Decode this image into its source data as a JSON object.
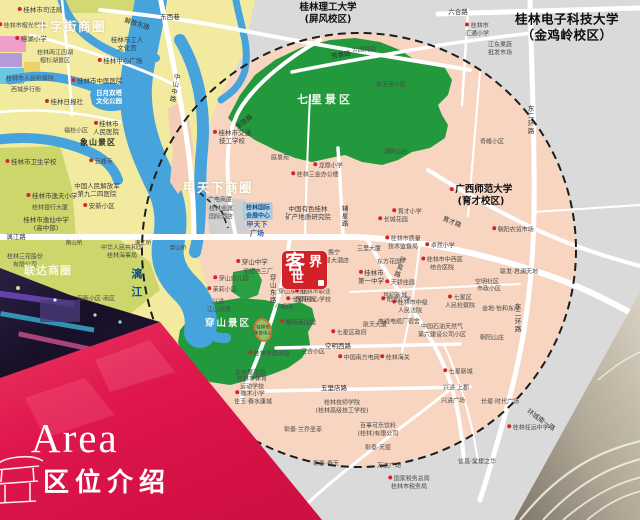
{
  "banner": {
    "title_en": "Area",
    "title_zh": "区位介绍"
  },
  "logo": {
    "c1": "客",
    "c2": "界",
    "c3": "世"
  },
  "colors": {
    "zone_pink": "#f7d5c0",
    "outside_gray": "#dadada",
    "downtown_yellow": "#f2eb9f",
    "yellow_green": "#cdd66b",
    "park_green": "#23993e",
    "river_blue": "#47a3dc",
    "road_white": "#ffffff",
    "logo_red": "#d32227",
    "banner_red": "#de164c",
    "dashed_boundary": "#1c1c1c"
  },
  "map": {
    "labels": [
      {
        "t": "桂林市司法局",
        "x": 40,
        "y": 10,
        "c": "poi",
        "m": 1
      },
      {
        "t": "桂林市榕光学校",
        "x": 22,
        "y": 26,
        "c": "poi-sm",
        "m": 1
      },
      {
        "t": "十字街商圈",
        "x": 71,
        "y": 27,
        "c": "biz"
      },
      {
        "t": "解放东路",
        "x": 137,
        "y": 24,
        "c": "road",
        "r": 18
      },
      {
        "t": "东西巷",
        "x": 170,
        "y": 17,
        "c": "road"
      },
      {
        "t": "榕湖小学",
        "x": 31,
        "y": 39,
        "c": "poi",
        "m": 1
      },
      {
        "t": "桂林市工人\n文化宫",
        "x": 127,
        "y": 44,
        "c": "poi"
      },
      {
        "t": "桂林中心广场",
        "x": 120,
        "y": 61,
        "c": "poi",
        "m": 1
      },
      {
        "t": "桂林两江四湖\n榕杉湖景区",
        "x": 55,
        "y": 57,
        "c": "poi-sm"
      },
      {
        "t": "桂林市人民检察院",
        "x": 30,
        "y": 79,
        "c": "poi-sm"
      },
      {
        "t": "桂林市中医医院",
        "x": 97,
        "y": 81,
        "c": "poi",
        "m": 1
      },
      {
        "t": "西城步行街",
        "x": 26,
        "y": 90,
        "c": "poi-sm"
      },
      {
        "t": "桂林日报社",
        "x": 64,
        "y": 102,
        "c": "poi",
        "m": 1
      },
      {
        "t": "日月双塔\n文化公园",
        "x": 109,
        "y": 97,
        "c": "wpark"
      },
      {
        "t": "中山中路",
        "x": 174,
        "y": 88,
        "c": "roadv",
        "r": 10
      },
      {
        "t": "桂林市\n人民医院",
        "x": 106,
        "y": 128,
        "c": "poi",
        "m": 1
      },
      {
        "t": "象山景区",
        "x": 98,
        "y": 143,
        "c": "scenic"
      },
      {
        "t": "福桂小区",
        "x": 76,
        "y": 131,
        "c": "poi-sm"
      },
      {
        "t": "桂林市卫生学校",
        "x": 31,
        "y": 162,
        "c": "poi",
        "m": 1
      },
      {
        "t": "云峰寺",
        "x": 101,
        "y": 162,
        "c": "poi-sm",
        "m": 1
      },
      {
        "t": "中国人民解放军\n第九二四医院",
        "x": 97,
        "y": 190,
        "c": "poi"
      },
      {
        "t": "桂林市逸夫小学",
        "x": 52,
        "y": 196,
        "c": "poi",
        "m": 1
      },
      {
        "t": "桂林银行大厦",
        "x": 50,
        "y": 208,
        "c": "poi-sm"
      },
      {
        "t": "桂林市逸仙中学\n(高中部)",
        "x": 46,
        "y": 224,
        "c": "poi"
      },
      {
        "t": "安新小区",
        "x": 99,
        "y": 206,
        "c": "poi",
        "m": 1
      },
      {
        "t": "漓江路",
        "x": 16,
        "y": 237,
        "c": "road"
      },
      {
        "t": "南山桥",
        "x": 74,
        "y": 244,
        "c": "bridge"
      },
      {
        "t": "漓江桥",
        "x": 143,
        "y": 244,
        "c": "bridge"
      },
      {
        "t": "穿山桥",
        "x": 178,
        "y": 249,
        "c": "bridge"
      },
      {
        "t": "中华人民共和国\n桂林海事局",
        "x": 122,
        "y": 252,
        "c": "poi-sm"
      },
      {
        "t": "桂林三花股份\n有限公司",
        "x": 25,
        "y": 261,
        "c": "poi-sm"
      },
      {
        "t": "联达商圈",
        "x": 48,
        "y": 271,
        "c": "biz2"
      },
      {
        "t": "漓江",
        "x": 136,
        "y": 286,
        "c": "water"
      },
      {
        "t": "安新小区·南区",
        "x": 96,
        "y": 299,
        "c": "poi-sm"
      },
      {
        "t": "茉莉小区",
        "x": 222,
        "y": 290,
        "c": "poi-sm",
        "m": 1
      },
      {
        "t": "兴进·\n江山领秀",
        "x": 219,
        "y": 306,
        "c": "poi-sm"
      },
      {
        "t": "穿山景区",
        "x": 228,
        "y": 324,
        "c": "park"
      },
      {
        "t": "桂林市\n体育中心",
        "x": 263,
        "y": 331,
        "c": "stadium"
      },
      {
        "t": "穿山中学",
        "x": 252,
        "y": 262,
        "c": "poi",
        "m": 1
      },
      {
        "t": "无线电三厂",
        "x": 258,
        "y": 272,
        "c": "poi-sm"
      },
      {
        "t": "穿山幼儿园",
        "x": 231,
        "y": 279,
        "c": "poi-sm",
        "m": 1
      },
      {
        "t": "桂林市职业\n教育中心学校",
        "x": 313,
        "y": 296,
        "c": "poi-sm",
        "m": 1
      },
      {
        "t": "穿山东路",
        "x": 272,
        "y": 289,
        "c": "roadv"
      },
      {
        "t": "穿山东社区",
        "x": 293,
        "y": 292,
        "c": "poi-sm"
      },
      {
        "t": "七星花园",
        "x": 301,
        "y": 300,
        "c": "poi-sm",
        "m": 1
      },
      {
        "t": "小甫园",
        "x": 284,
        "y": 307,
        "c": "poi-sm"
      },
      {
        "t": "樱特莱庄园",
        "x": 298,
        "y": 323,
        "c": "poi-sm",
        "m": 1
      },
      {
        "t": "达京樱花园",
        "x": 250,
        "y": 373,
        "c": "poi-sm"
      },
      {
        "t": "桂林市体育\n运动学校",
        "x": 252,
        "y": 383,
        "c": "poi-sm"
      },
      {
        "t": "橡木小学",
        "x": 250,
        "y": 394,
        "c": "poi-sm",
        "m": 1
      },
      {
        "t": "佳玉·春水康城",
        "x": 253,
        "y": 402,
        "c": "poi-sm"
      },
      {
        "t": "龙隐路",
        "x": 244,
        "y": 122,
        "c": "road",
        "r": -38
      },
      {
        "t": "桂林市交通\n技工学校",
        "x": 232,
        "y": 137,
        "c": "poi",
        "m": 1
      },
      {
        "t": "甲天下商圈",
        "x": 218,
        "y": 188,
        "c": "biz"
      },
      {
        "t": "广电商厦",
        "x": 220,
        "y": 200,
        "c": "poi-sm"
      },
      {
        "t": "桂林金属\n国际酒店",
        "x": 221,
        "y": 213,
        "c": "poi-sm"
      },
      {
        "t": "桂林国际\n会展中心",
        "x": 258,
        "y": 212,
        "c": "expo"
      },
      {
        "t": "甲天下\n广场",
        "x": 257,
        "y": 229,
        "c": "blue-bold"
      },
      {
        "t": "中国有色桂林\n矿产地质研究院",
        "x": 308,
        "y": 213,
        "c": "poi"
      },
      {
        "t": "桂林三金办公楼",
        "x": 315,
        "y": 175,
        "c": "poi-sm",
        "m": 1
      },
      {
        "t": "龙隐小学",
        "x": 328,
        "y": 166,
        "c": "poi-sm",
        "m": 1
      },
      {
        "t": "庭景苑",
        "x": 280,
        "y": 158,
        "c": "poi-sm"
      },
      {
        "t": "辅星路",
        "x": 344,
        "y": 216,
        "c": "roadv"
      },
      {
        "t": "七星景区",
        "x": 325,
        "y": 100,
        "c": "park-lg"
      },
      {
        "t": "桂林理工大学\n(屏风校区)",
        "x": 328,
        "y": 14,
        "c": "u1"
      },
      {
        "t": "芳香路",
        "x": 341,
        "y": 55,
        "c": "road",
        "r": -10
      },
      {
        "t": "公园林韵",
        "x": 364,
        "y": 50,
        "c": "poi-sm"
      },
      {
        "t": "航天苑小区",
        "x": 391,
        "y": 85,
        "c": "poi-sm"
      },
      {
        "t": "湖畔山庄",
        "x": 396,
        "y": 152,
        "c": "poi-sm"
      },
      {
        "t": "六合路",
        "x": 458,
        "y": 12,
        "c": "road"
      },
      {
        "t": "桂林市\n汇通小学",
        "x": 477,
        "y": 30,
        "c": "poi-sm",
        "m": 1
      },
      {
        "t": "江东果蔬\n批发市场",
        "x": 500,
        "y": 49,
        "c": "poi-sm"
      },
      {
        "t": "桂林电子科技大学\n（金鸡岭校区）",
        "x": 567,
        "y": 27,
        "c": "u2"
      },
      {
        "t": "东二环路",
        "x": 530,
        "y": 120,
        "c": "roadv"
      },
      {
        "t": "奇峰小区",
        "x": 492,
        "y": 142,
        "c": "poi-sm"
      },
      {
        "t": "携宁\n七星大酒店",
        "x": 334,
        "y": 257,
        "c": "poi-sm"
      },
      {
        "t": "天骄佳园",
        "x": 400,
        "y": 283,
        "c": "poi-sm",
        "m": 1
      },
      {
        "t": "世纪新城",
        "x": 395,
        "y": 296,
        "c": "poi-sm"
      },
      {
        "t": "桂林市中级\n人民法院",
        "x": 410,
        "y": 307,
        "c": "poi-sm",
        "m": 1
      },
      {
        "t": "三里大厦",
        "x": 369,
        "y": 249,
        "c": "poi-sm"
      },
      {
        "t": "东方花园",
        "x": 389,
        "y": 262,
        "c": "poi-sm"
      },
      {
        "t": "桂林市\n第一中学",
        "x": 371,
        "y": 277,
        "c": "poi",
        "m": 1
      },
      {
        "t": "骖鸾路",
        "x": 399,
        "y": 267,
        "c": "roadv",
        "r": 20
      },
      {
        "t": "桂林市质量\n技术监督局",
        "x": 403,
        "y": 243,
        "c": "poi-sm",
        "m": 1
      },
      {
        "t": "长城花园",
        "x": 393,
        "y": 220,
        "c": "poi-sm",
        "m": 1
      },
      {
        "t": "育才小学",
        "x": 407,
        "y": 212,
        "c": "poi-sm",
        "m": 1
      },
      {
        "t": "广西师范大学\n(育才校区)",
        "x": 481,
        "y": 196,
        "c": "u1",
        "m": 1
      },
      {
        "t": "育才路",
        "x": 452,
        "y": 222,
        "c": "road",
        "r": 22
      },
      {
        "t": "朝阳农贸市场",
        "x": 513,
        "y": 230,
        "c": "poi-sm",
        "m": 1
      },
      {
        "t": "卓然小学",
        "x": 440,
        "y": 246,
        "c": "poi-sm",
        "m": 1
      },
      {
        "t": "桂林市中西医\n结合医院",
        "x": 442,
        "y": 264,
        "c": "poi-sm",
        "m": 1
      },
      {
        "t": "联发·君澜天地",
        "x": 519,
        "y": 272,
        "c": "poi-sm"
      },
      {
        "t": "空明社区",
        "x": 487,
        "y": 282,
        "c": "poi-sm"
      },
      {
        "t": "市政小区",
        "x": 489,
        "y": 289,
        "c": "poi-sm"
      },
      {
        "t": "七星区\n人民检察院",
        "x": 460,
        "y": 302,
        "c": "poi-sm",
        "m": 1
      },
      {
        "t": "金地·怡和东岸",
        "x": 501,
        "y": 309,
        "c": "poi-sm"
      },
      {
        "t": "阳光小学",
        "x": 396,
        "y": 300,
        "c": "poi-sm",
        "m": 1
      },
      {
        "t": "电线电缆厂宿舍",
        "x": 399,
        "y": 322,
        "c": "poi-sm"
      },
      {
        "t": "中国石油天然气\n第六建设公司小区",
        "x": 442,
        "y": 331,
        "c": "poi-sm"
      },
      {
        "t": "东二环路",
        "x": 517,
        "y": 318,
        "c": "roadv"
      },
      {
        "t": "朝阳山庄",
        "x": 492,
        "y": 338,
        "c": "poi-sm"
      },
      {
        "t": "七星区政府",
        "x": 349,
        "y": 333,
        "c": "poi-sm",
        "m": 1
      },
      {
        "t": "航天大厦",
        "x": 375,
        "y": 325,
        "c": "poi-sm"
      },
      {
        "t": "空明西路",
        "x": 338,
        "y": 346,
        "c": "road"
      },
      {
        "t": "桂林市游泳馆",
        "x": 269,
        "y": 354,
        "c": "poi-sm",
        "m": 1
      },
      {
        "t": "三合小区",
        "x": 313,
        "y": 352,
        "c": "poi-sm"
      },
      {
        "t": "中国南方电网",
        "x": 359,
        "y": 358,
        "c": "poi-sm",
        "m": 1
      },
      {
        "t": "桂林海关",
        "x": 395,
        "y": 358,
        "c": "poi-sm",
        "m": 1
      },
      {
        "t": "五里店路",
        "x": 334,
        "y": 388,
        "c": "road"
      },
      {
        "t": "桂林技师学院\n(桂林高级技工学校)",
        "x": 342,
        "y": 407,
        "c": "poi-sm"
      },
      {
        "t": "彰泰·兰乔圣菲",
        "x": 303,
        "y": 430,
        "c": "poi-sm"
      },
      {
        "t": "百事可乐饮料\n(桂林)有限公司",
        "x": 378,
        "y": 430,
        "c": "poi-sm"
      },
      {
        "t": "彰泰·天宸",
        "x": 378,
        "y": 448,
        "c": "poi-sm"
      },
      {
        "t": "彰泰·春天",
        "x": 326,
        "y": 464,
        "c": "poi-sm"
      },
      {
        "t": "万达广场",
        "x": 389,
        "y": 466,
        "c": "poi-sm"
      },
      {
        "t": "国家税务总局\n桂林市税务局",
        "x": 409,
        "y": 483,
        "c": "poi-sm",
        "m": 1
      },
      {
        "t": "七星新城",
        "x": 458,
        "y": 372,
        "c": "poi-sm",
        "m": 1
      },
      {
        "t": "兴进·上郡",
        "x": 456,
        "y": 388,
        "c": "poi-sm"
      },
      {
        "t": "兴进广场",
        "x": 453,
        "y": 401,
        "c": "poi-sm"
      },
      {
        "t": "长堤·时代广场",
        "x": 500,
        "y": 402,
        "c": "poi-sm"
      },
      {
        "t": "桂林任远中学",
        "x": 528,
        "y": 428,
        "c": "poi-sm",
        "m": 1
      },
      {
        "t": "信昌·棠棣之华",
        "x": 477,
        "y": 462,
        "c": "poi-sm"
      },
      {
        "t": "环城南一路",
        "x": 541,
        "y": 420,
        "c": "road",
        "r": 35
      }
    ]
  }
}
